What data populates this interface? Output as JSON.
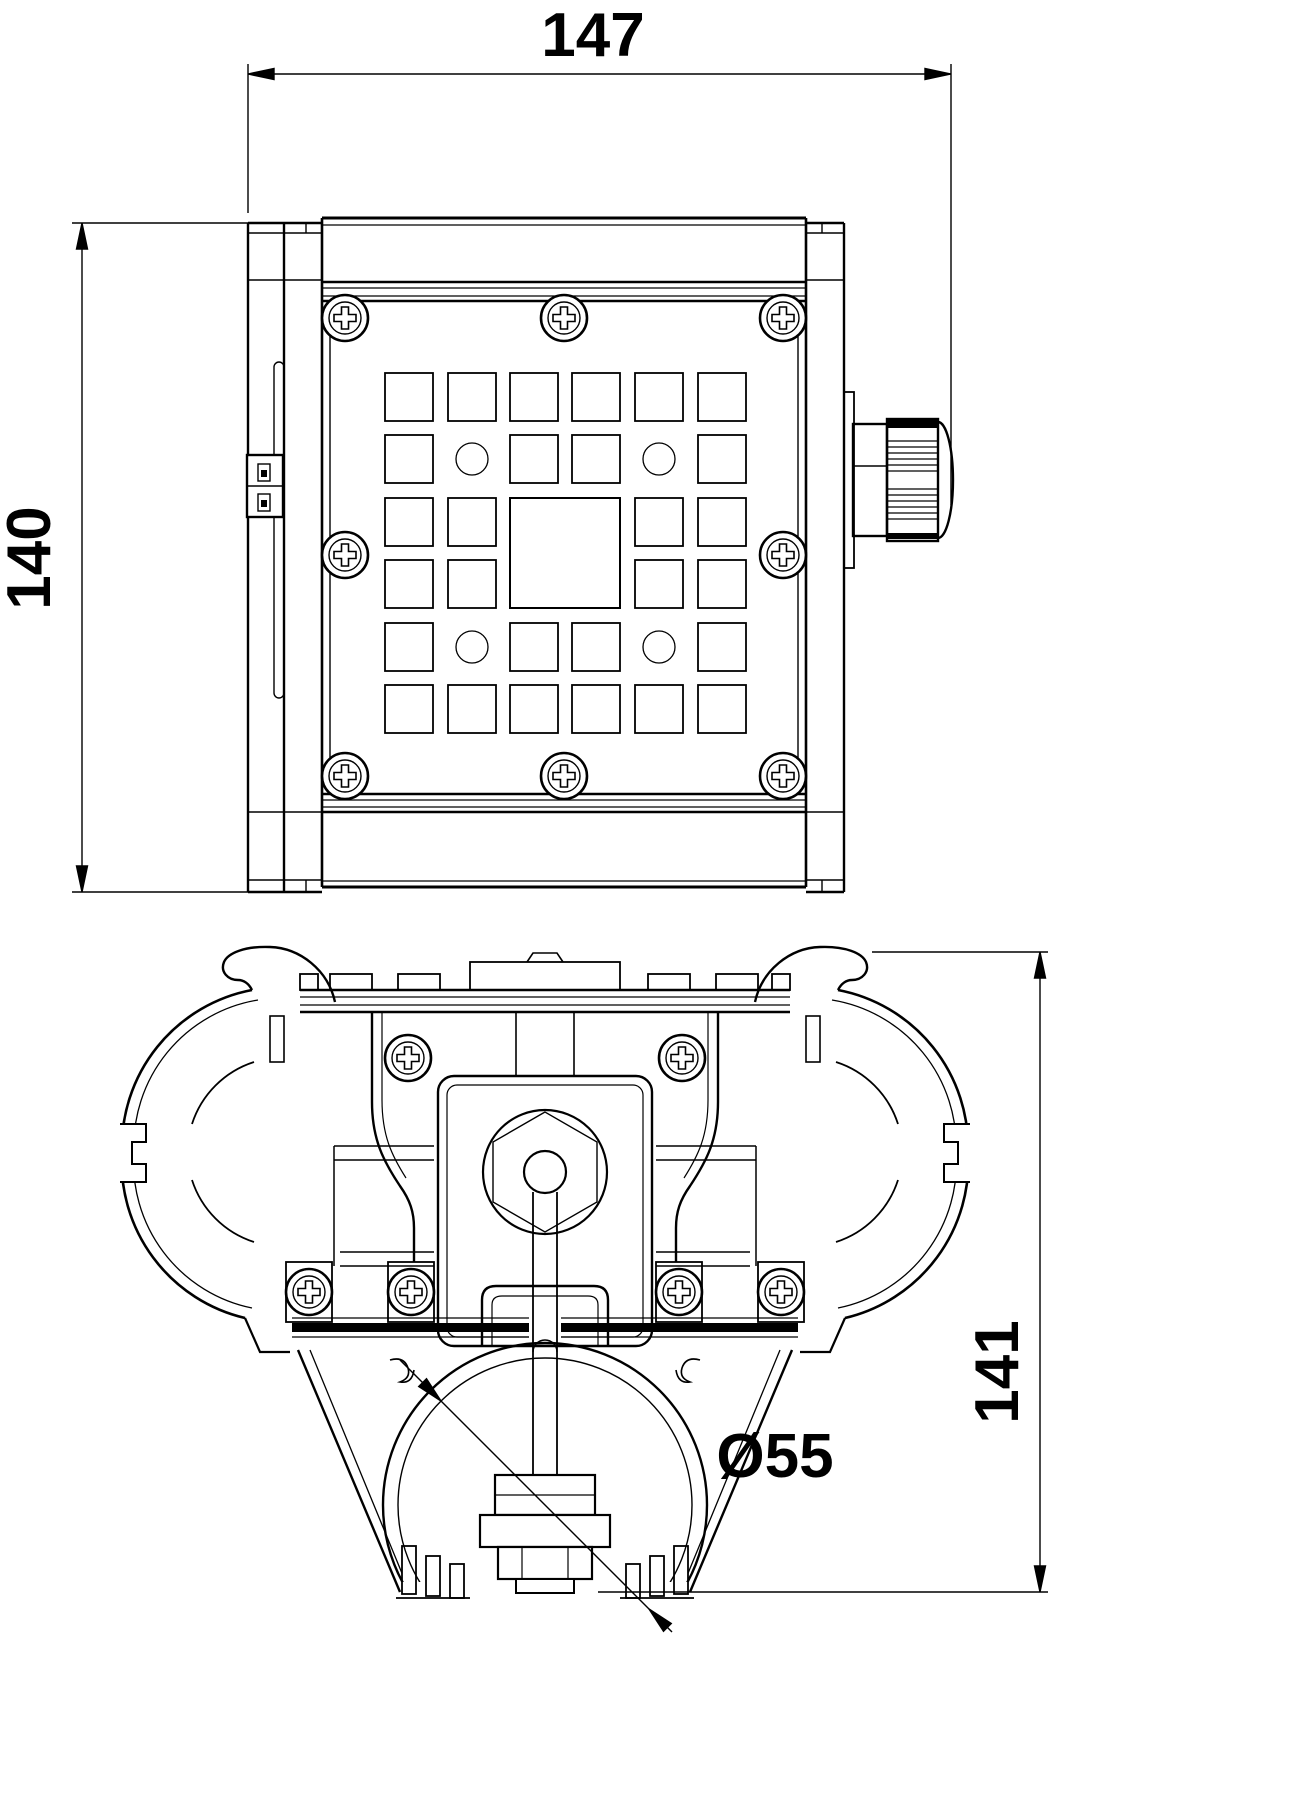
{
  "drawing": {
    "type": "technical-drawing",
    "background": "#ffffff",
    "line_color": "#000000",
    "views": {
      "front": "led-floodlight-front-view",
      "side": "led-floodlight-side-section-view"
    },
    "dimensions": {
      "overall_width": "147",
      "overall_height": "140",
      "side_height": "141",
      "tube_diameter": "Ø55"
    }
  }
}
